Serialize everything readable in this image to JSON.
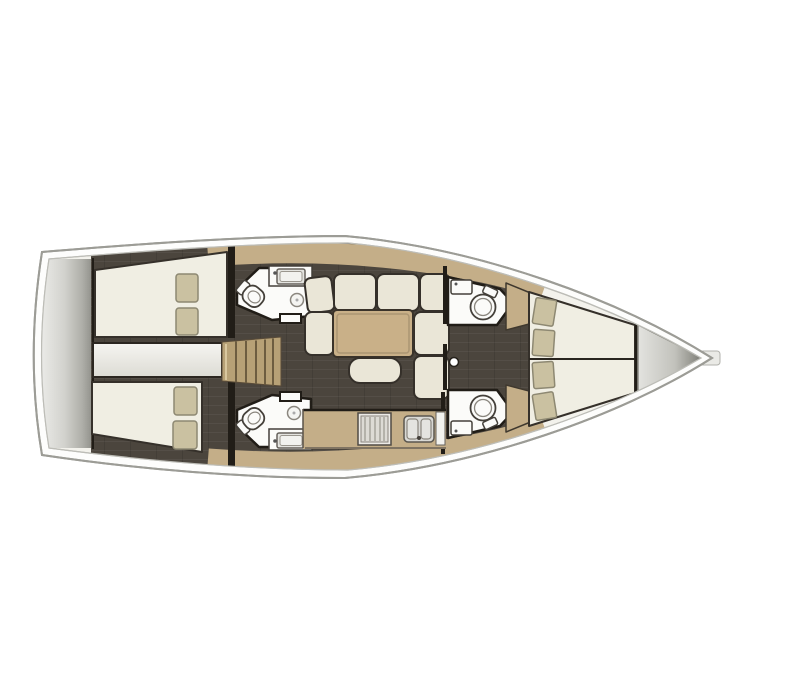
{
  "diagram": {
    "type": "yacht-interior-floor-plan",
    "view": "top-down",
    "orientation": "bow-right",
    "rooms": [
      {
        "id": "swim-platform",
        "label": "transom swim platform"
      },
      {
        "id": "aft-cabin-port",
        "label": "aft double cabin port",
        "features": [
          "double berth",
          "2 pillows"
        ]
      },
      {
        "id": "aft-cabin-starboard",
        "label": "aft double cabin starboard",
        "features": [
          "double berth",
          "2 pillows"
        ]
      },
      {
        "id": "engine-compartment",
        "label": "engine compartment"
      },
      {
        "id": "companionway",
        "label": "companionway steps"
      },
      {
        "id": "head-aft-port",
        "label": "aft head port",
        "features": [
          "toilet",
          "sink",
          "shower drain"
        ]
      },
      {
        "id": "head-aft-starboard",
        "label": "aft head starboard",
        "features": [
          "toilet",
          "sink",
          "shower drain"
        ]
      },
      {
        "id": "saloon",
        "label": "saloon",
        "features": [
          "u-shaped settee",
          "table",
          "ottoman",
          "mast post"
        ]
      },
      {
        "id": "galley",
        "label": "galley",
        "features": [
          "stove",
          "double sink",
          "counter"
        ]
      },
      {
        "id": "head-fwd-port",
        "label": "forward head port",
        "features": [
          "toilet",
          "sink"
        ]
      },
      {
        "id": "head-fwd-starboard",
        "label": "forward head starboard",
        "features": [
          "toilet",
          "sink"
        ]
      },
      {
        "id": "forward-cabin",
        "label": "forward V-berth cabin",
        "features": [
          "double berth",
          "4 pillows"
        ]
      },
      {
        "id": "anchor-locker",
        "label": "bow anchor locker"
      }
    ],
    "colors": {
      "hull_line": "#9c9c96",
      "deck": "#f3f2ec",
      "floor_dark": "#4b453d",
      "wall": "#211d17",
      "wood_tan": "#c4ae88",
      "steps": "#b7a176",
      "upholstery": "#eae6d7",
      "berth": "#f0eee3",
      "upholstery_line": "#35302a",
      "pillow": "#cac1a1",
      "pillow_line": "#8d8872",
      "fixture_white": "#fbfbf9",
      "fixture_line": "#44403a",
      "metal_gray": "#d9d9d5"
    }
  }
}
